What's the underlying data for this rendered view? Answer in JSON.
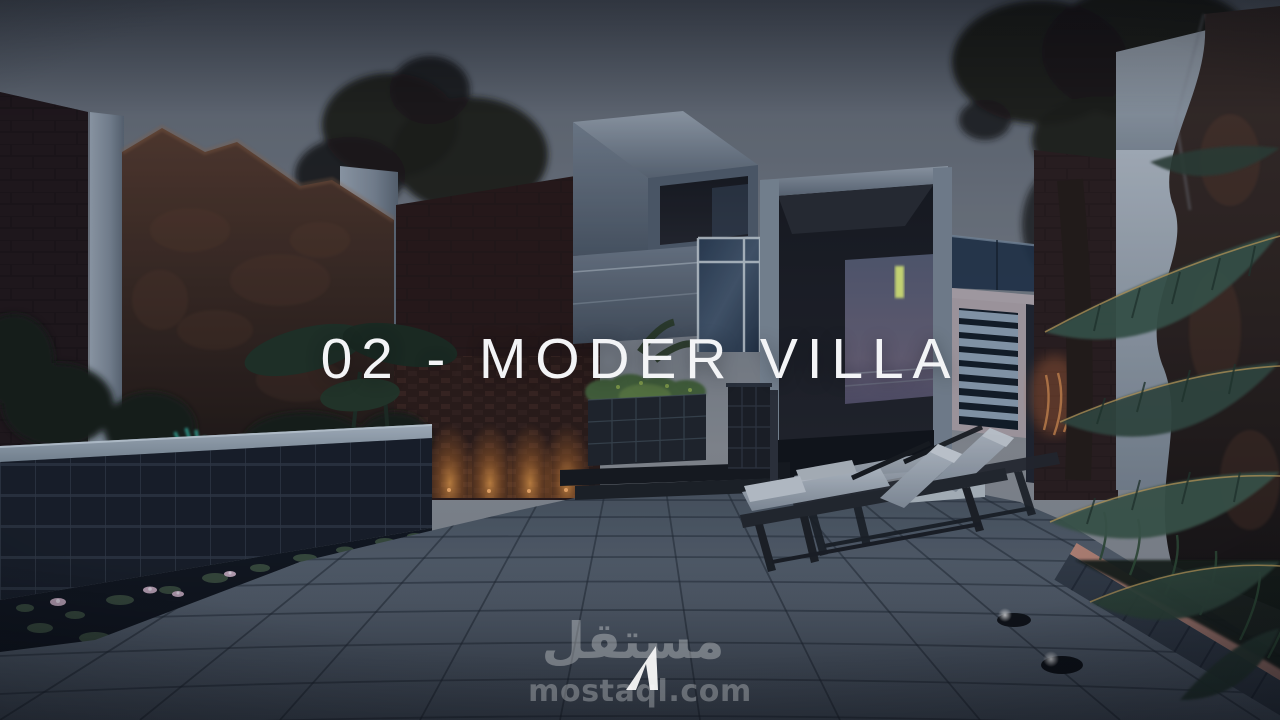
{
  "title": {
    "text": "02 - MODER VILLA"
  },
  "watermark": {
    "arabic": "مستقل",
    "domain": "mostaql.com",
    "logo": "mostaql-triangle-logo"
  },
  "colors": {
    "sky_top": "#5c636e",
    "sky_mid": "#7a8089",
    "sky_bottom": "#8d9197",
    "title_color": "#f3f4f6",
    "watermark_color": "#ffffff",
    "uplight_orange": "#d97b2e",
    "lamp_yellow": "#dfee7c",
    "leaf_teal": "#37b8a6",
    "cushion_light": "#c3cad3",
    "paving": "#59636f",
    "paving_line": "#232a34",
    "water_dark": "#10141c",
    "rock_brown": "#45302a",
    "brick_dark": "#2a1d1f",
    "villa_face": "#8b95a3",
    "glass_blue": "#3a4f66",
    "pink_light": "#b97f72"
  }
}
